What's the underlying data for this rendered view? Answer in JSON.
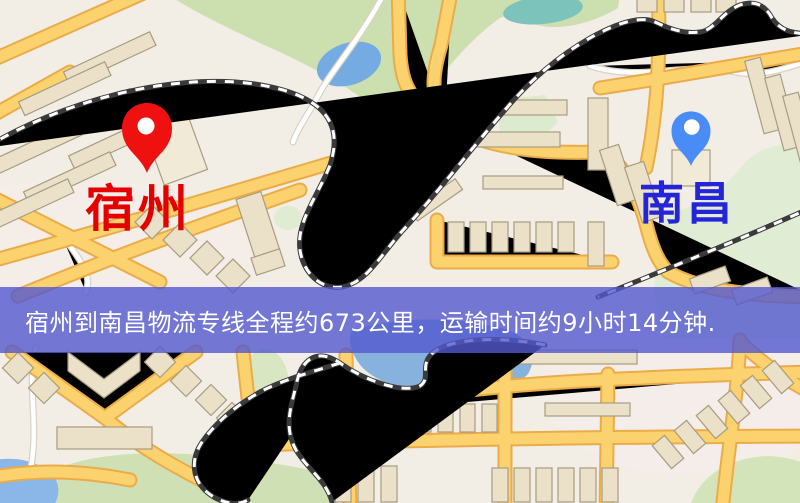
{
  "window": {
    "width": 800,
    "height": 503
  },
  "map": {
    "type": "street-map",
    "palette": {
      "background": "#f2eee6",
      "road_fill": "#fbd26e",
      "road_casing": "#eaac48",
      "minor_road": "#ffffff",
      "building_fill": "#eae1c8",
      "building_stroke": "#a89c80",
      "park_green": "#ccdfae",
      "water_blue": "#85b1dd",
      "pond_teal": "#7cc3bb",
      "railway_dark": "#3a3a3a"
    }
  },
  "markers": {
    "origin": {
      "label": "宿州",
      "label_color": "#e50000",
      "pin_color": "#ef1010",
      "pin_style": "map-pin"
    },
    "destination": {
      "label": "南昌",
      "label_color": "#2424d8",
      "pin_color": "#4a8cf5",
      "pin_style": "map-pin"
    }
  },
  "banner": {
    "text": "宿州到南昌物流专线全程约673公里，运输时间约9小时14分钟.",
    "background": "#5256ce",
    "text_color": "#ffffff",
    "route": {
      "from": "宿州",
      "to": "南昌",
      "distance_km": 673,
      "duration_hours": 9,
      "duration_minutes": 14
    }
  }
}
